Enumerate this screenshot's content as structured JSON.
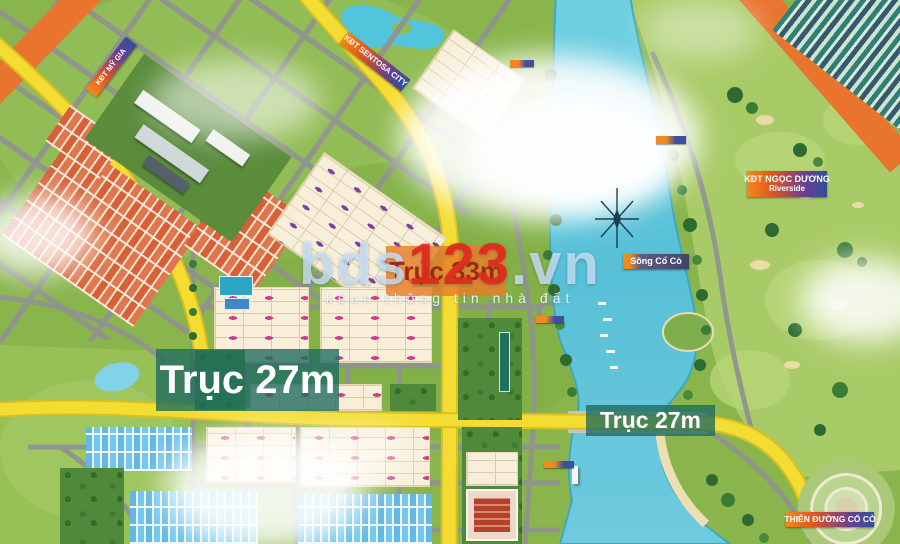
{
  "watermark": {
    "brand_prefix": "bds",
    "brand_number": "123",
    "brand_suffix": ".vn",
    "tagline": "kênh thông tin nhà đất"
  },
  "labels": {
    "kdt_my_gia": "KĐT MỸ GIA",
    "kdt_sentosa": "KĐT SENTOSA CITY",
    "kdt_ngoc_duong_line1": "KĐT NGỌC DƯƠNG",
    "kdt_ngoc_duong_line2": "Riverside",
    "song_co_co": "Sông Cổ Cò",
    "thien_duong_co_co": "THIÊN ĐƯỜNG CỔ CÒ",
    "truc_33m": "Trục 33m",
    "truc_27m_left": "Trục 27m",
    "truc_27m_right": "Trục 27m"
  },
  "palette": {
    "yellow_road": "#f4dd33",
    "orange_road": "#e8742e",
    "river": "#5cc3d8",
    "teal_overlay": "#1c6a5e",
    "banner_orange": "#f08a1e",
    "banner_blue": "#2f4f9e",
    "watermark_red": "#e22a18"
  }
}
